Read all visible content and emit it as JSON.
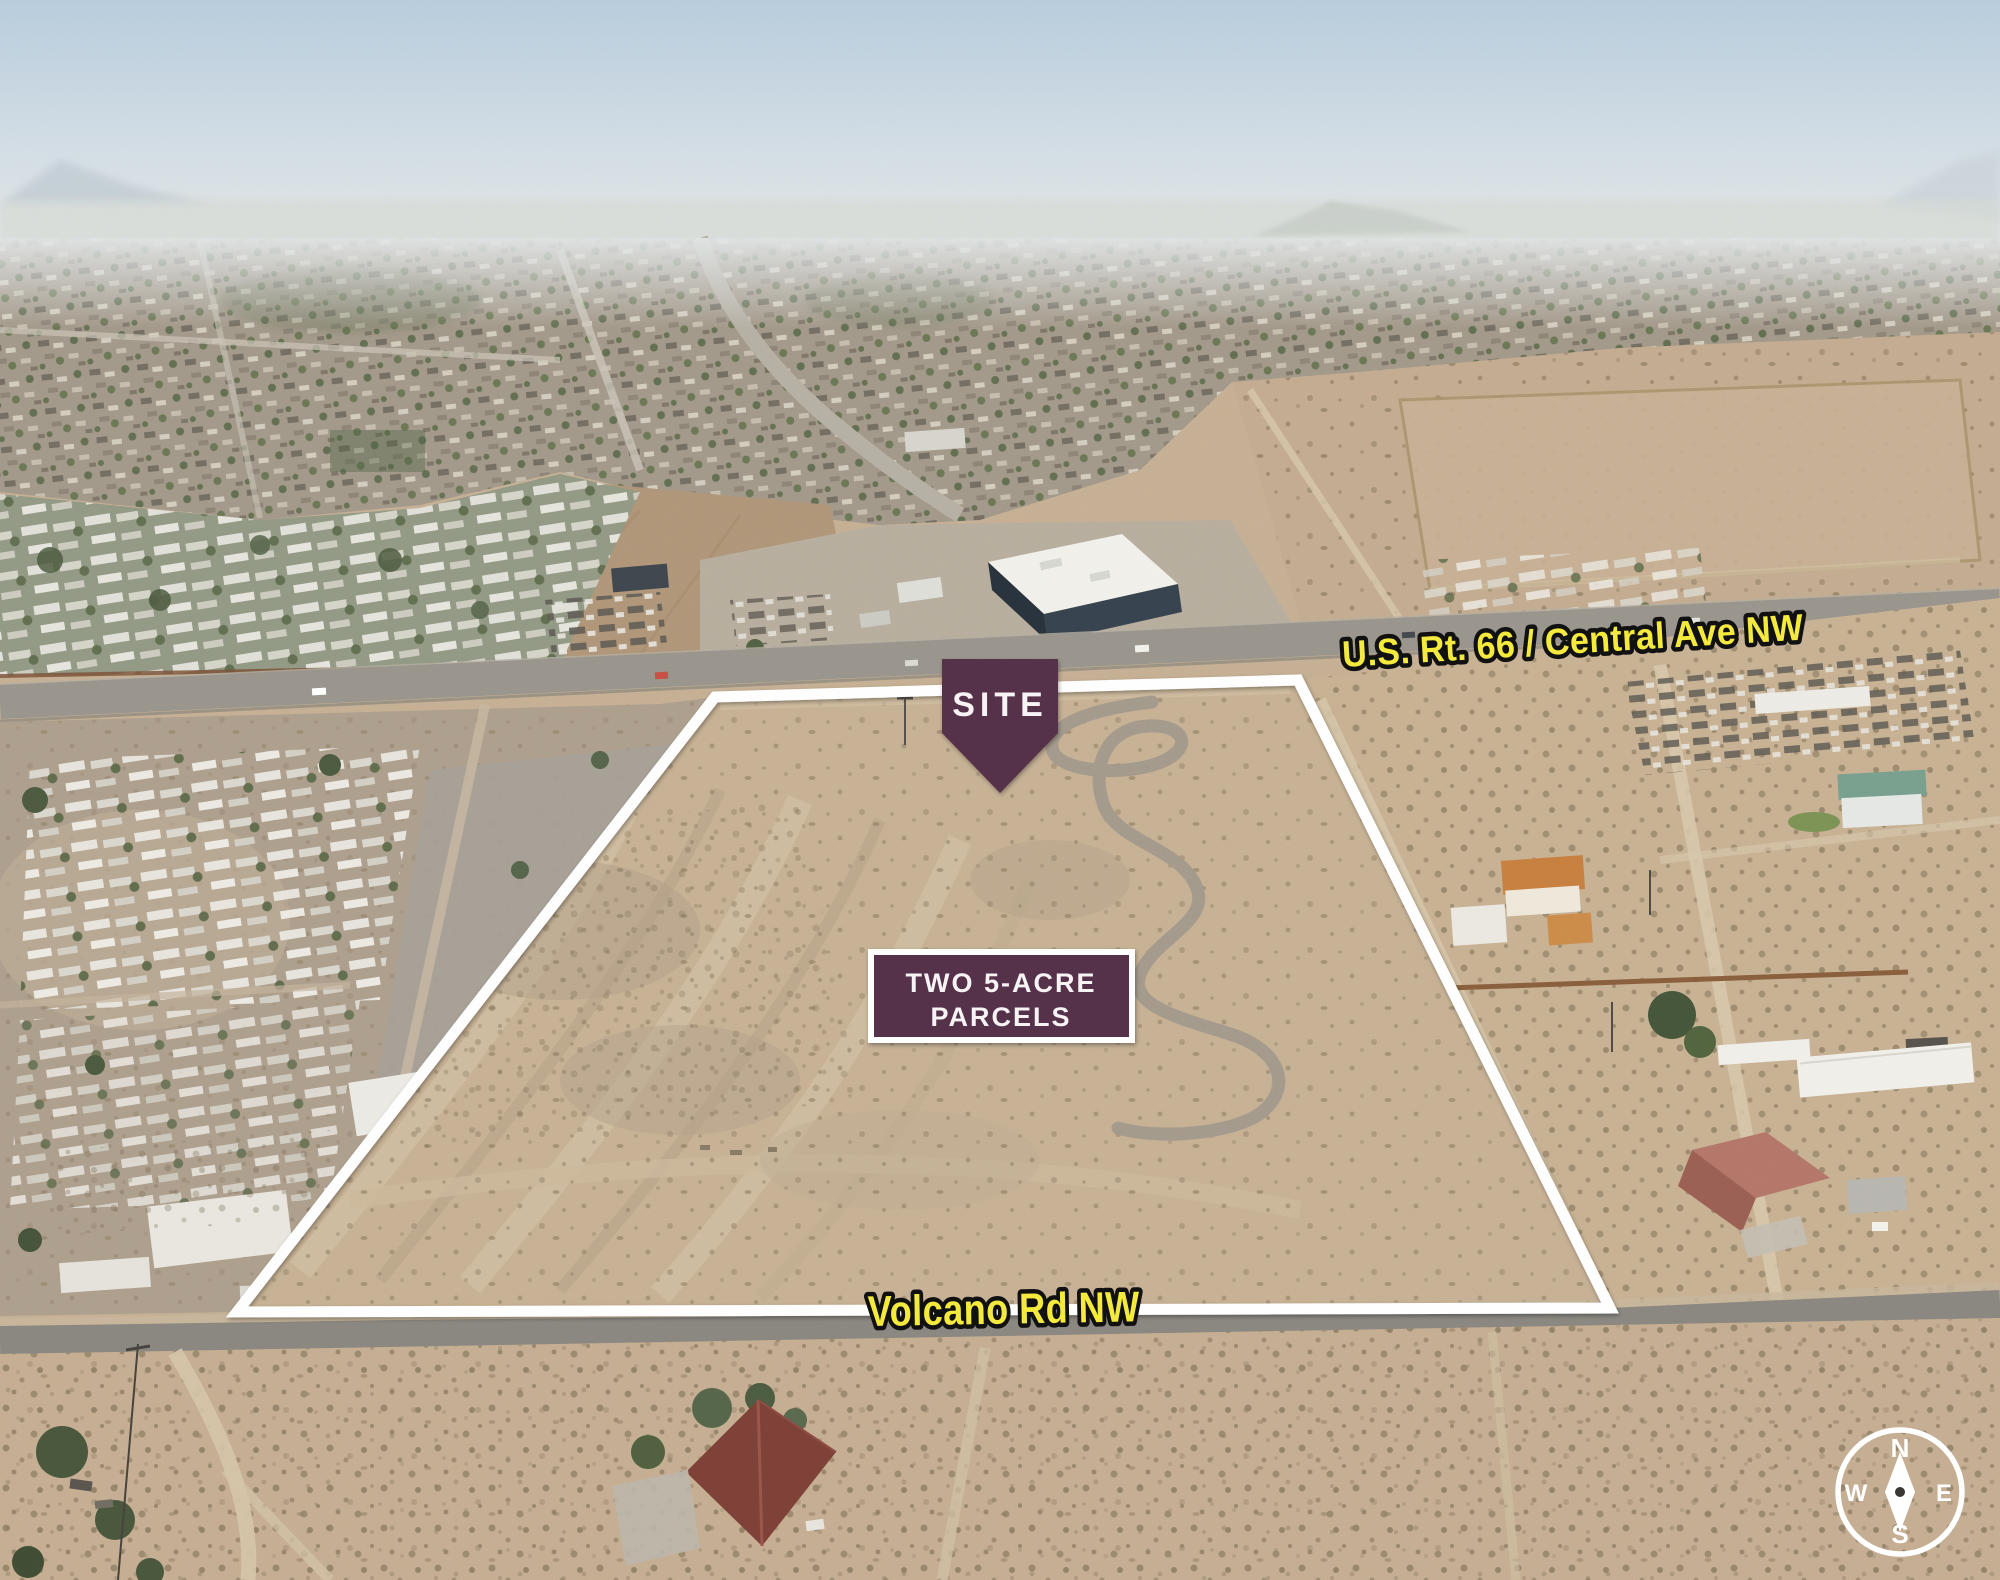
{
  "site_marker": {
    "label": "SITE"
  },
  "parcel_badge": {
    "line1": "TWO 5-ACRE",
    "line2": "PARCELS"
  },
  "road_labels": {
    "highway": "U.S. Rt. 66 / Central Ave NW",
    "south_road": "Volcano Rd NW"
  },
  "compass": {
    "n": "N",
    "e": "E",
    "s": "S",
    "w": "W"
  },
  "colors": {
    "accent_purple": "#54304a",
    "label_yellow": "#f3ea3d",
    "label_outline_black": "#111111",
    "boundary_white": "#ffffff",
    "label_text_white": "#f7f3f5"
  }
}
